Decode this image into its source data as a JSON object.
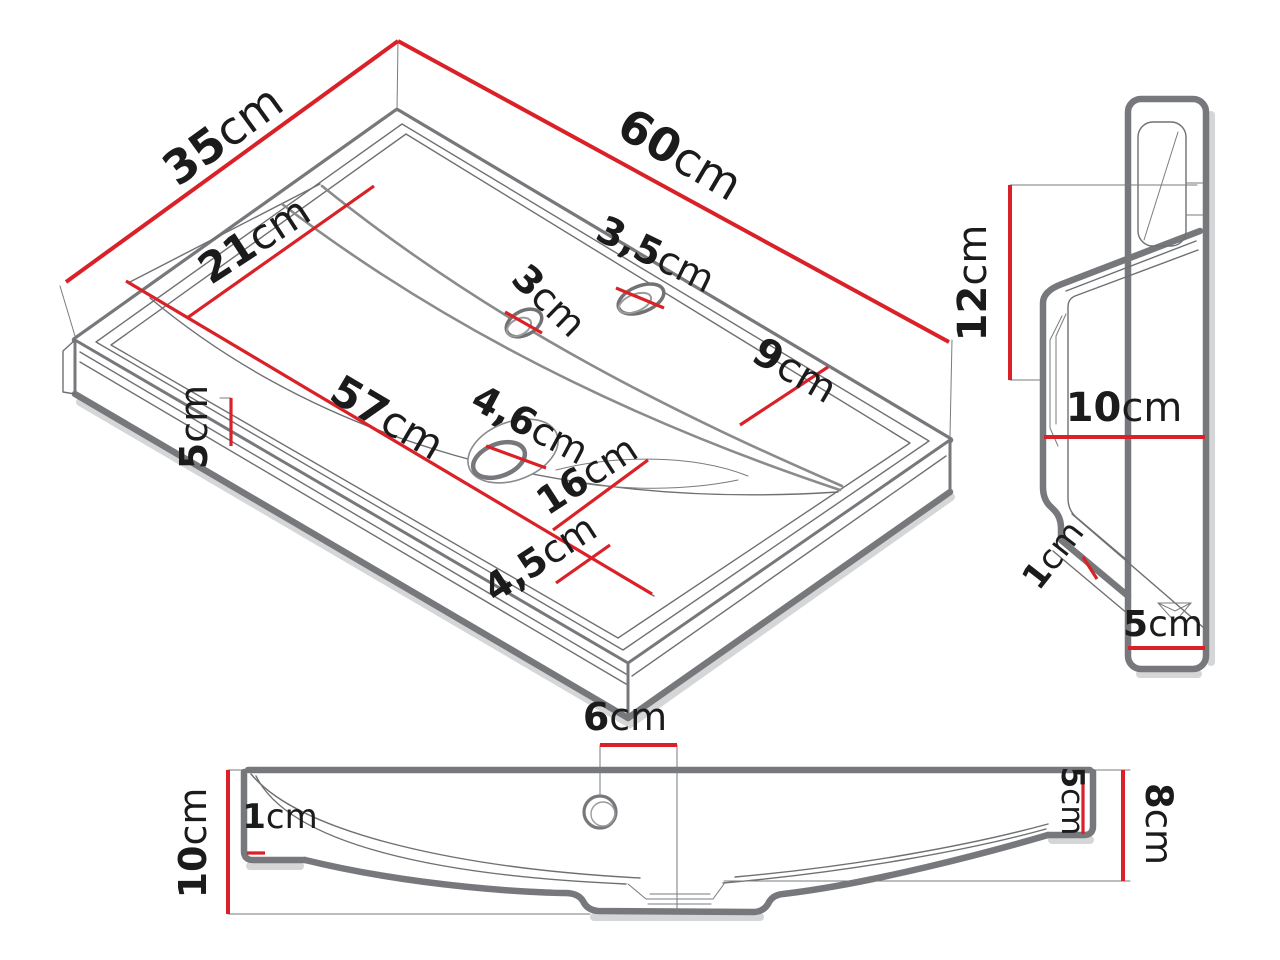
{
  "figure": {
    "kind": "technical-dimension-drawing",
    "subject": "wall-mounted washbasin shown in isometric, side and front views",
    "background": "#ffffff"
  },
  "colors": {
    "dimension_red": "#da2128",
    "outline_gray": "#77787b",
    "detail_gray": "#6f7072",
    "text_black": "#1b1b1b"
  },
  "views": {
    "isometric": {
      "name": "isometric-top-view",
      "dims": [
        {
          "label": "depth",
          "value": "35",
          "unit": "cm"
        },
        {
          "label": "width",
          "value": "60",
          "unit": "cm"
        },
        {
          "label": "inner-depth",
          "value": "21",
          "unit": "cm"
        },
        {
          "label": "faucet-hole",
          "value": "3",
          "unit": "cm"
        },
        {
          "label": "overflow-hole",
          "value": "3,5",
          "unit": "cm"
        },
        {
          "label": "deck-depth",
          "value": "9",
          "unit": "cm"
        },
        {
          "label": "inner-width",
          "value": "57",
          "unit": "cm"
        },
        {
          "label": "front-height",
          "value": "5",
          "unit": "cm"
        },
        {
          "label": "drain-hole",
          "value": "4,6",
          "unit": "cm"
        },
        {
          "label": "drain-to-front",
          "value": "16",
          "unit": "cm"
        },
        {
          "label": "front-rim",
          "value": "4,5",
          "unit": "cm"
        }
      ]
    },
    "side": {
      "name": "side-profile-view",
      "dims": [
        {
          "label": "total-height",
          "value": "12",
          "unit": "cm"
        },
        {
          "label": "mid-depth",
          "value": "10",
          "unit": "cm"
        },
        {
          "label": "wall-thickness",
          "value": "1",
          "unit": "cm"
        },
        {
          "label": "bottom-flange",
          "value": "5",
          "unit": "cm"
        }
      ]
    },
    "front": {
      "name": "front-elevation-view",
      "dims": [
        {
          "label": "faucet-offset",
          "value": "6",
          "unit": "cm"
        },
        {
          "label": "rim-thickness",
          "value": "1",
          "unit": "cm"
        },
        {
          "label": "left-height",
          "value": "10",
          "unit": "cm"
        },
        {
          "label": "end-cap-height",
          "value": "5",
          "unit": "cm"
        },
        {
          "label": "right-height",
          "value": "8",
          "unit": "cm"
        }
      ]
    }
  }
}
